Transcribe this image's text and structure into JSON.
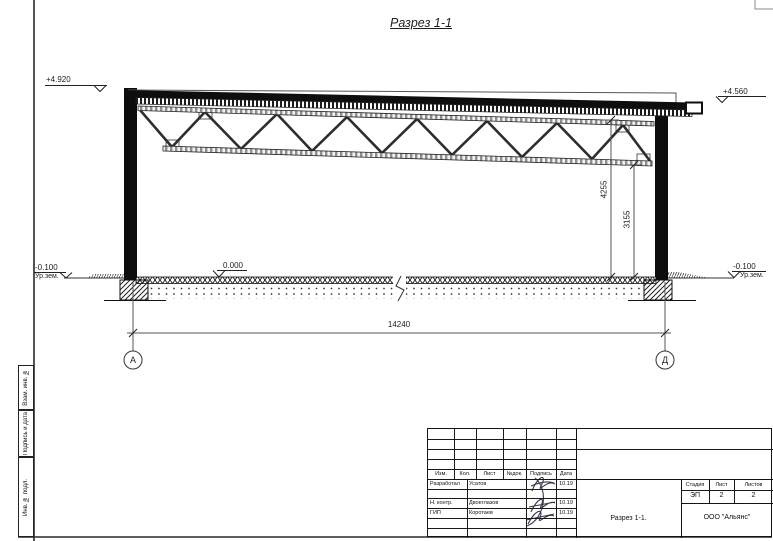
{
  "sheet": {
    "title": "Разрез 1-1",
    "margin_labels": {
      "top": "Взам. инв. №",
      "middle": "Подпись и дата",
      "bottom": "Инв. № подл."
    }
  },
  "drawing": {
    "elevations": {
      "roof_left": "+4.920",
      "roof_right": "+4.560",
      "floor": "0.000",
      "ground_left": "-0.100",
      "ground_left_label": "Ур.зем.",
      "ground_right": "-0.100",
      "ground_right_label": "Ур.зем."
    },
    "dimensions": {
      "span": "14240",
      "truss_top_height": "4255",
      "truss_bottom_height": "3155"
    },
    "axes": {
      "left": "А",
      "right": "Д"
    }
  },
  "title_block": {
    "rev_headers": [
      "Изм.",
      "Кол.",
      "Лист",
      "№док.",
      "Подпись",
      "Дата"
    ],
    "rows": [
      {
        "role": "Разработал",
        "name": "Усатов",
        "date": "10.19"
      },
      {
        "role": "Н. контр.",
        "name": "Двоеглазов",
        "date": "10.19"
      },
      {
        "role": "ГИП",
        "name": "Коротаев",
        "date": "10.19"
      }
    ],
    "stage_headers": [
      "Стадия",
      "Лист",
      "Листов"
    ],
    "stage": "ЭП",
    "sheet_no": "2",
    "sheets_total": "2",
    "doc_name": "Разрез 1-1.",
    "company": "ООО \"Альянс\""
  }
}
